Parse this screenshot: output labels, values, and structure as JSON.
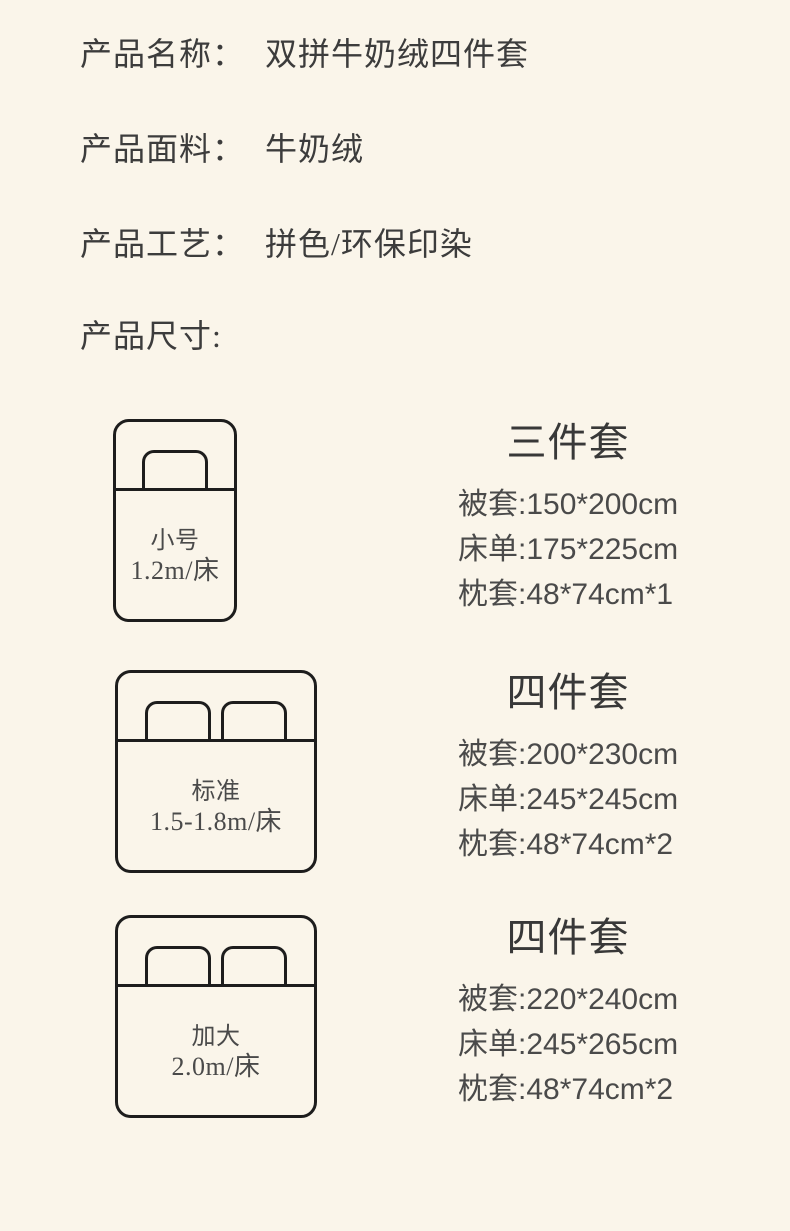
{
  "theme": {
    "background_color": "#FAF5EA",
    "heading_color": "#3C3C3C",
    "spec_text_color": "#4A4A4A",
    "diagram_line_color": "#1D1D1D"
  },
  "product_info": {
    "rows": [
      {
        "label": "产品名称：",
        "value": "双拼牛奶绒四件套"
      },
      {
        "label": "产品面料：",
        "value": "牛奶绒"
      },
      {
        "label": "产品工艺：",
        "value": "拼色/环保印染"
      },
      {
        "label": "产品尺寸:",
        "value": ""
      }
    ]
  },
  "size_sections": [
    {
      "bed": {
        "label": "小号",
        "size": "1.2m/床",
        "pillow_count": 1
      },
      "spec": {
        "title": "三件套",
        "items": [
          "被套:150*200cm",
          "床单:175*225cm",
          "枕套:48*74cm*1"
        ]
      }
    },
    {
      "bed": {
        "label": "标准",
        "size": "1.5-1.8m/床",
        "pillow_count": 2
      },
      "spec": {
        "title": "四件套",
        "items": [
          "被套:200*230cm",
          "床单:245*245cm",
          "枕套:48*74cm*2"
        ]
      }
    },
    {
      "bed": {
        "label": "加大",
        "size": "2.0m/床",
        "pillow_count": 2
      },
      "spec": {
        "title": "四件套",
        "items": [
          "被套:220*240cm",
          "床单:245*265cm",
          "枕套:48*74cm*2"
        ]
      }
    }
  ]
}
